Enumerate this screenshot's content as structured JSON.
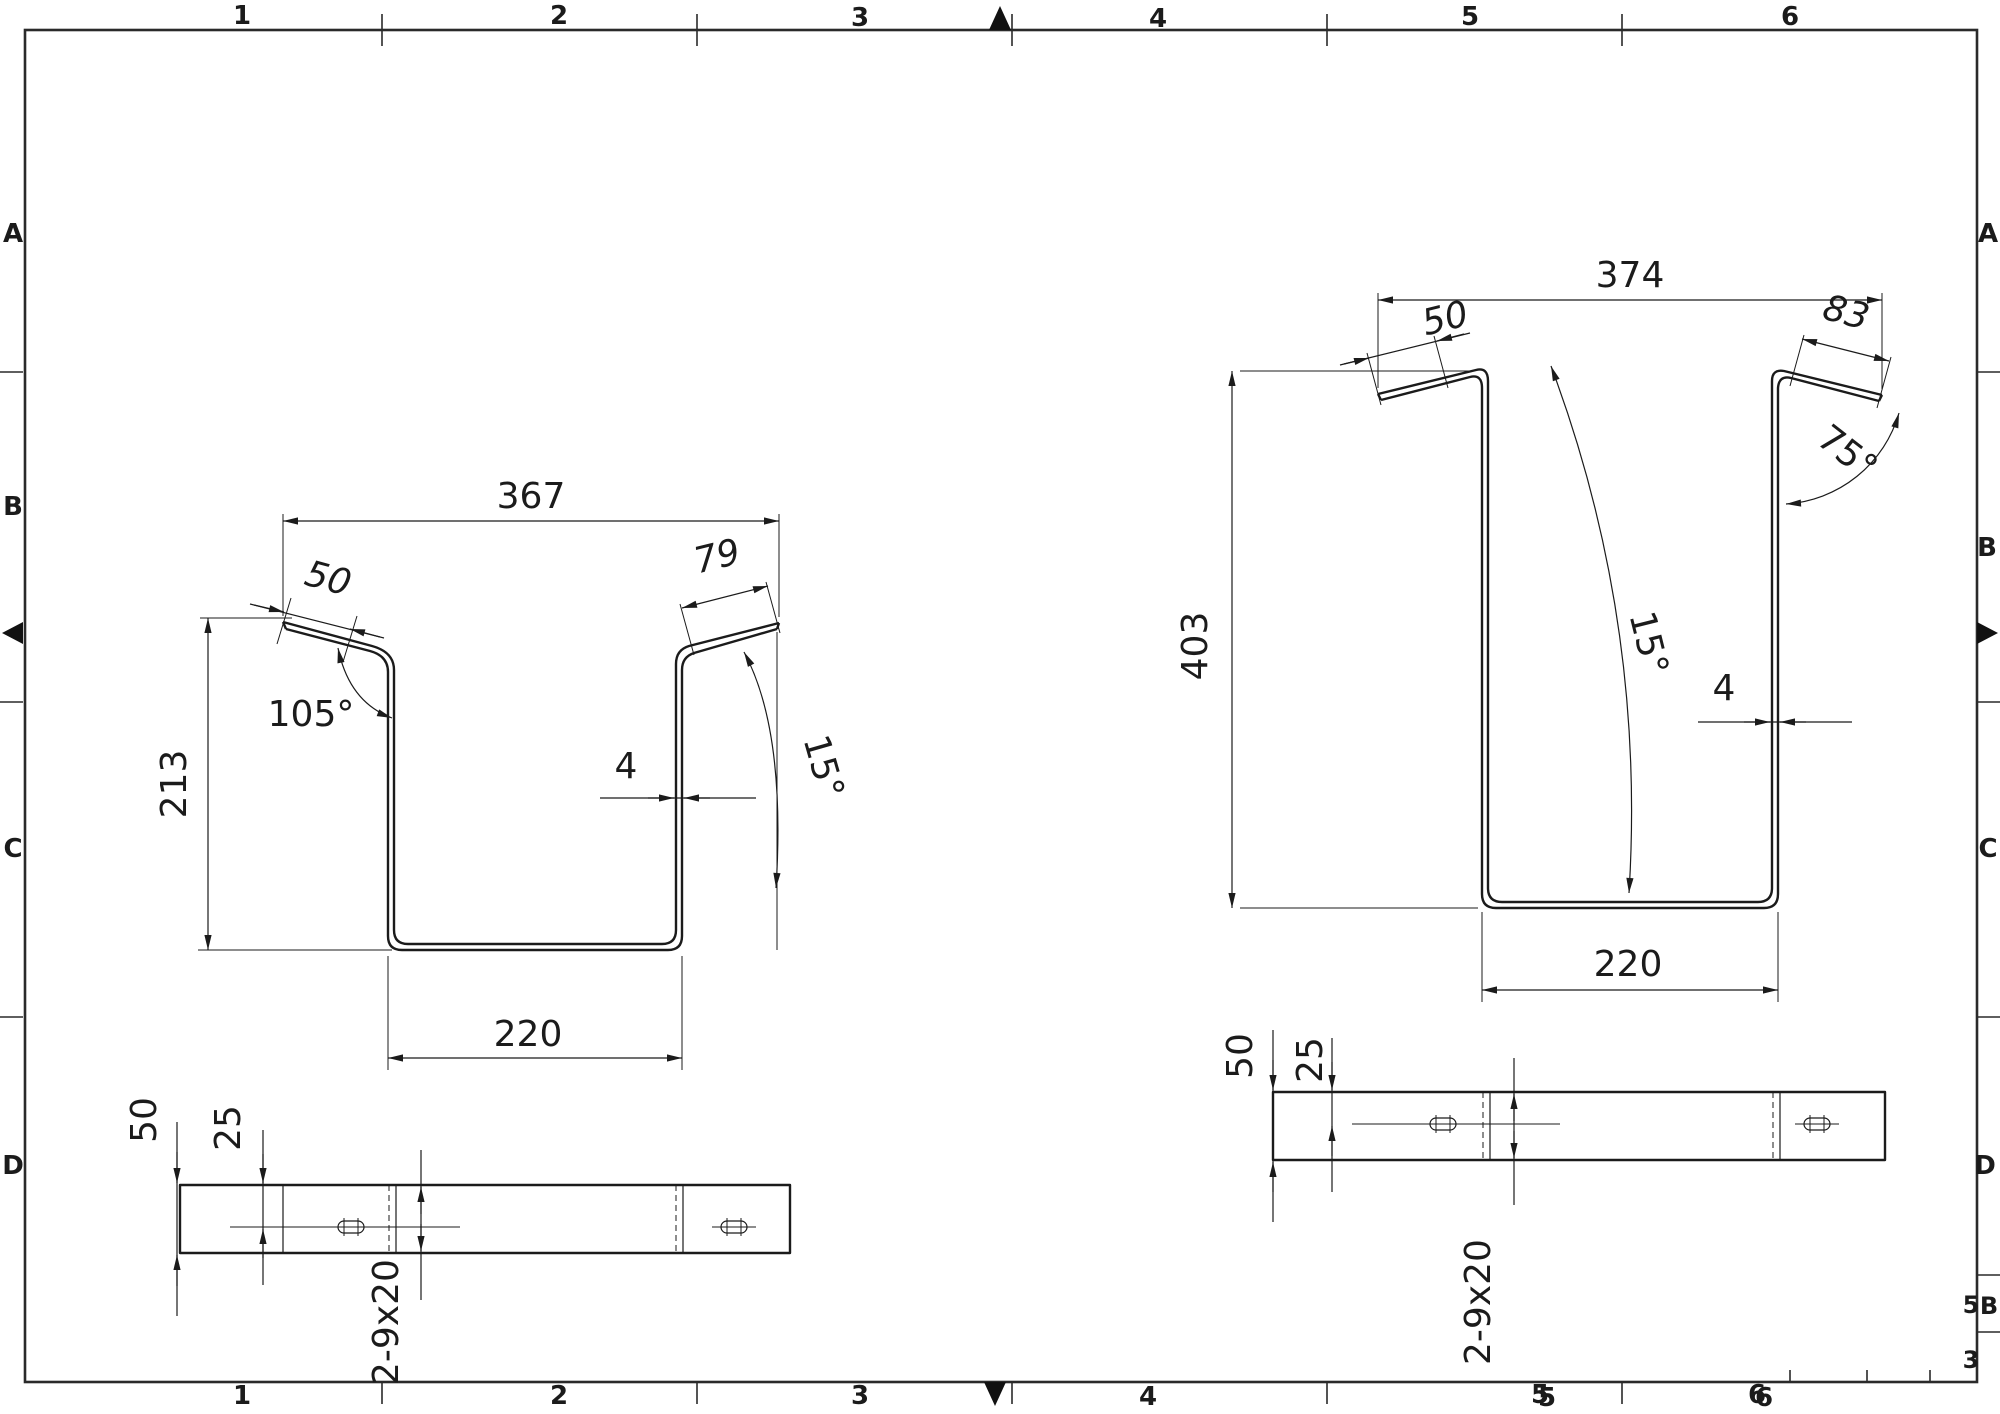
{
  "frame": {
    "zone_columns_top": [
      "1",
      "2",
      "3",
      "4",
      "5",
      "6"
    ],
    "zone_columns_bottom": [
      "1",
      "2",
      "3",
      "4",
      "5",
      "6"
    ],
    "zone_rows_left": [
      "A",
      "B",
      "C",
      "D"
    ],
    "zone_rows_right": [
      "A",
      "B",
      "C",
      "D"
    ],
    "artifacts": {
      "edge_letter": "B",
      "clipped_upper": "5",
      "clipped_lower": "3"
    }
  },
  "left_view": {
    "dim_top_width": "367",
    "dim_flange_left": "50",
    "dim_flange_right": "79",
    "dim_angle_flange": "105°",
    "dim_height": "213",
    "dim_thickness": "4",
    "dim_angle_wall": "15°",
    "dim_bottom_width": "220"
  },
  "right_view": {
    "dim_top_width": "374",
    "dim_flange_left": "50",
    "dim_flange_right": "83",
    "dim_angle_flange": "75°",
    "dim_height": "403",
    "dim_angle_wall": "15°",
    "dim_thickness": "4",
    "dim_bottom_width": "220"
  },
  "plan_left": {
    "dim_width": "50",
    "dim_to_center": "25",
    "dim_slots": "2-9x20"
  },
  "plan_right": {
    "dim_width": "50",
    "dim_to_center": "25",
    "dim_slots": "2-9x20"
  }
}
